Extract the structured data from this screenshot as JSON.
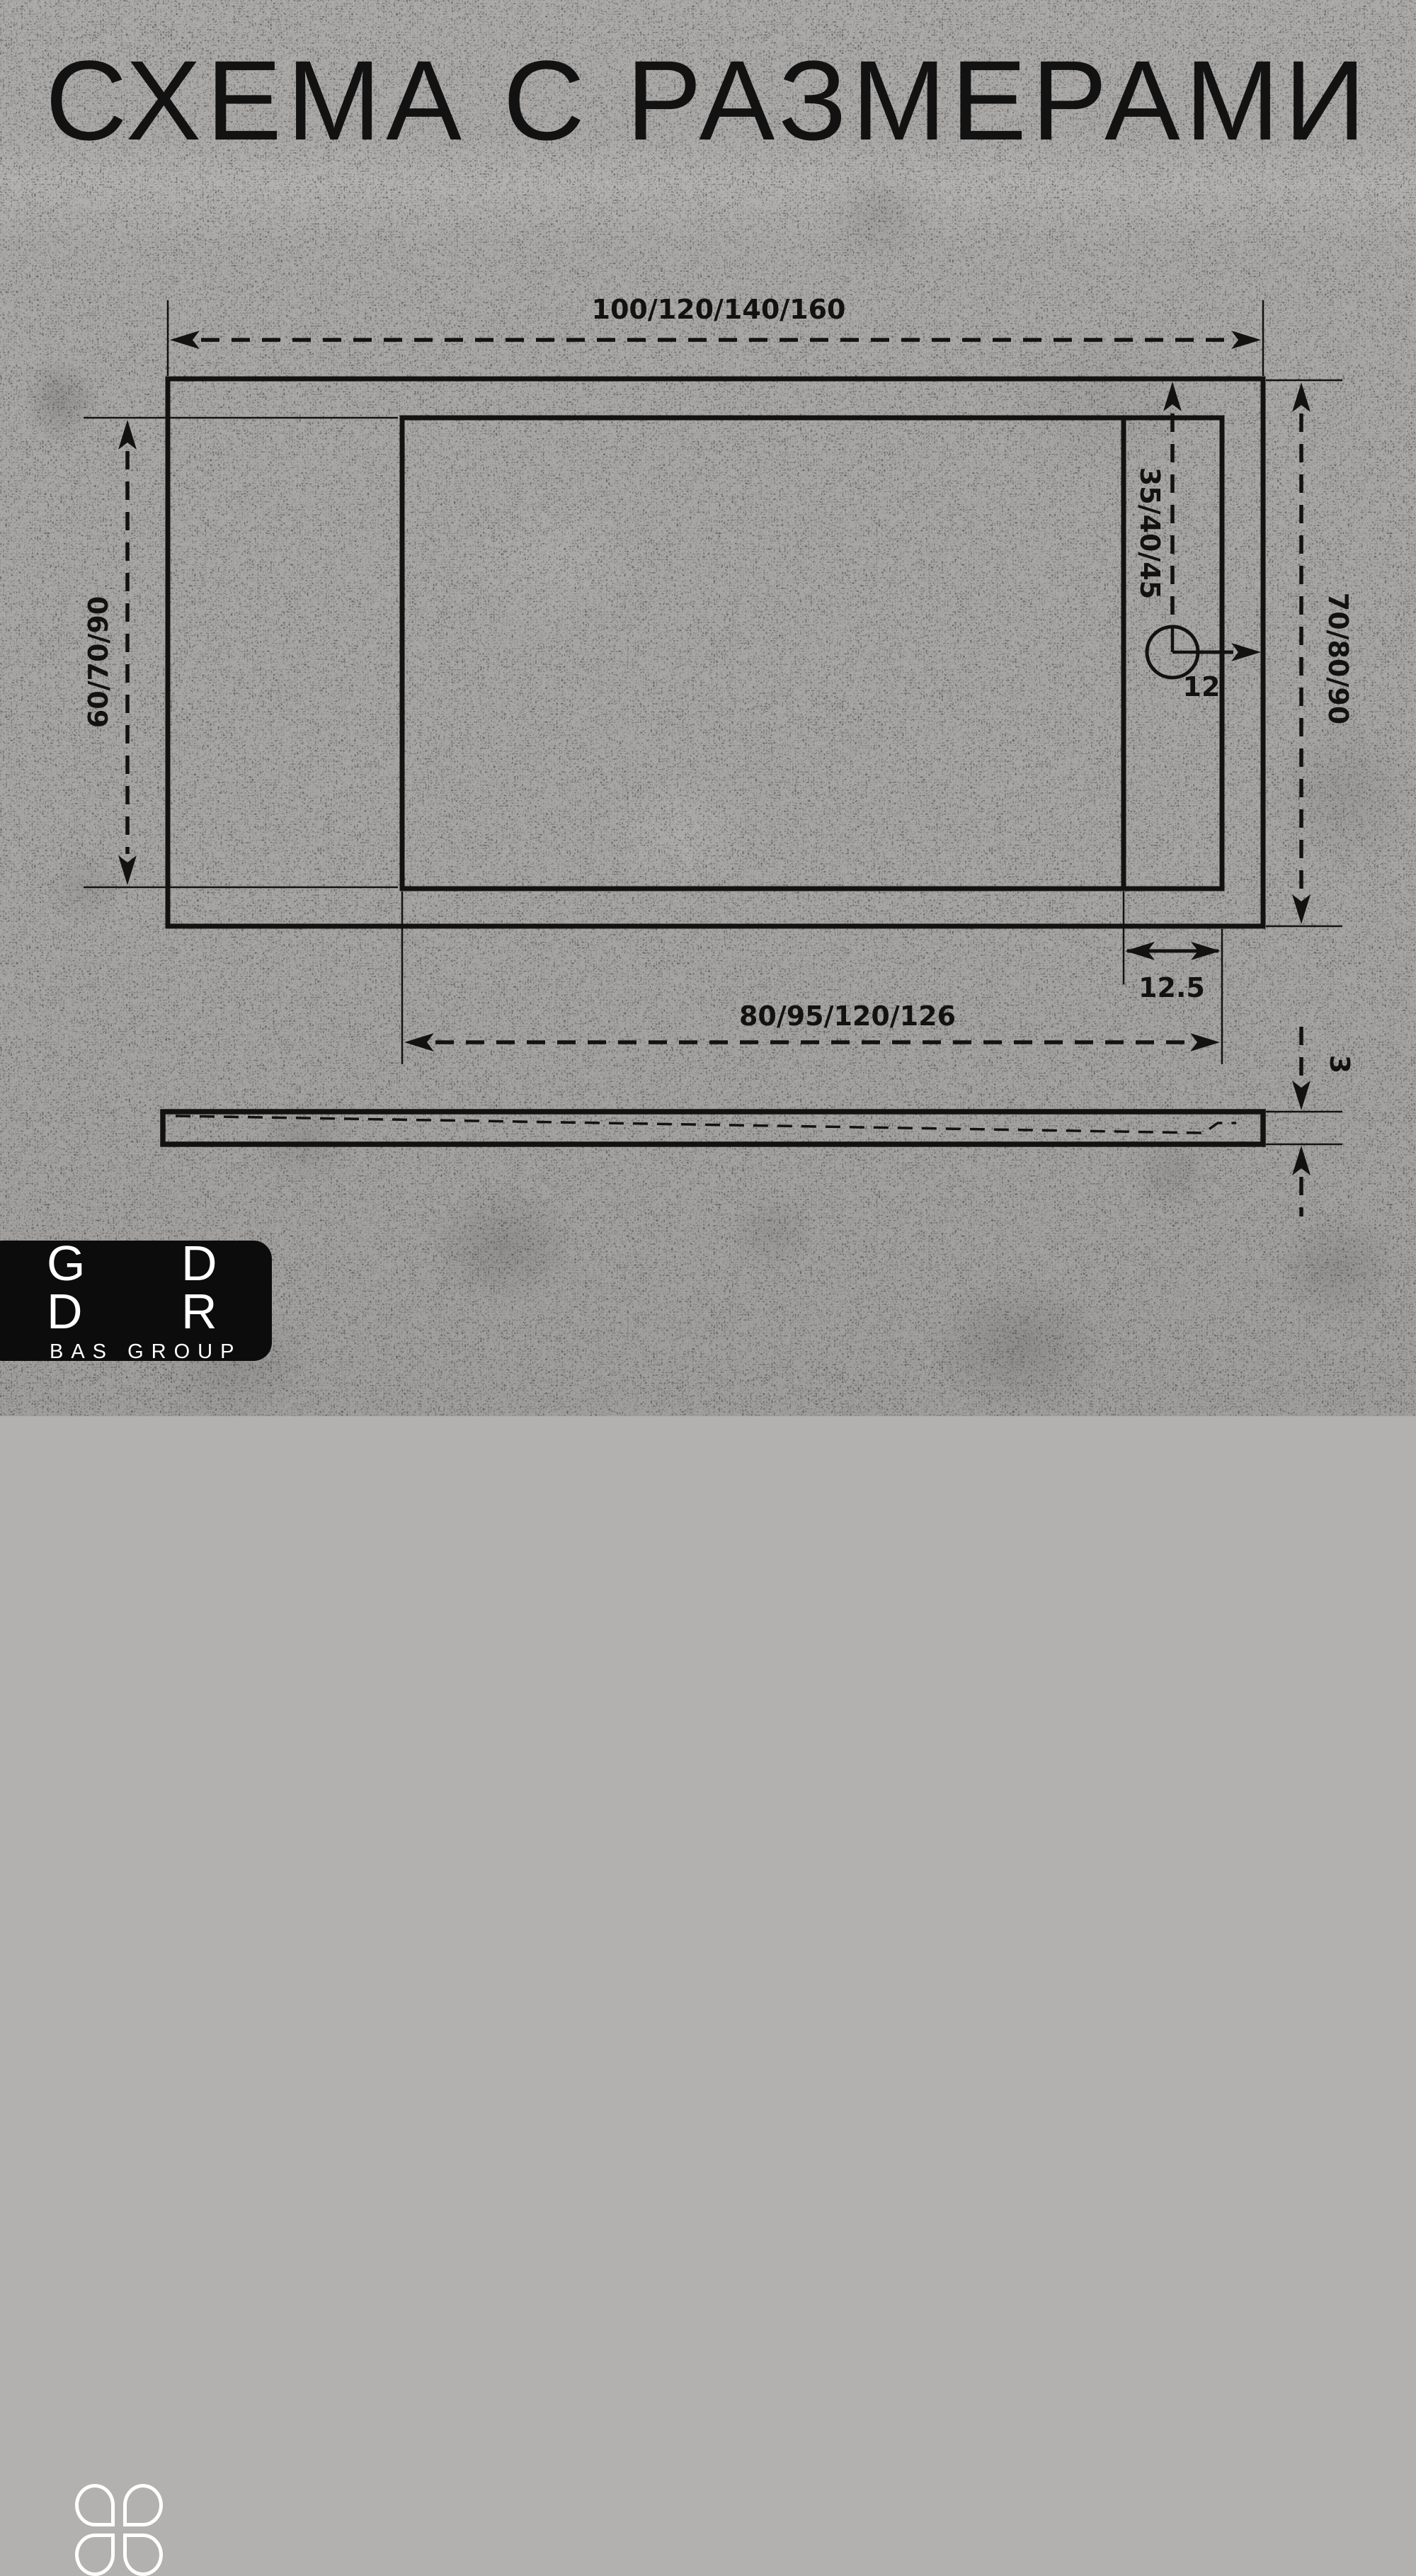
{
  "title": "СХЕМА С РАЗМЕРАМИ",
  "dimensions": {
    "overall_width": "100/120/140/160",
    "basin_height_left": "60/70/90",
    "overall_height_right": "70/80/90",
    "drain_offset_from_top": "35/40/45",
    "drain_diameter": "12",
    "drain_strip_width": "12.5",
    "basin_width_bottom": "80/95/120/126",
    "tray_thickness": "3"
  },
  "logo": {
    "top_first_letter": "G",
    "top_last_letter": "D",
    "bottom_first_letter": "D",
    "bottom_last_letter": "R",
    "subtitle": "BAS GROUP"
  },
  "colors": {
    "ink": "#121212",
    "background": "#b3b1af",
    "logo_background": "#0c0c0c",
    "logo_text": "#ffffff"
  }
}
